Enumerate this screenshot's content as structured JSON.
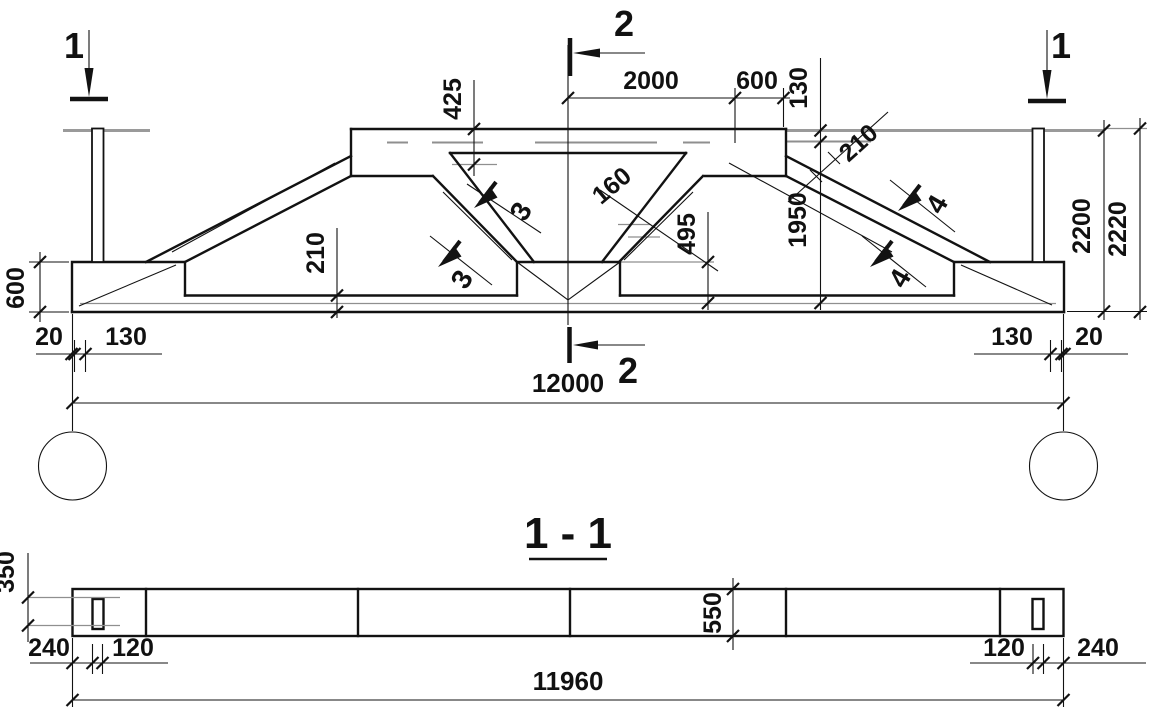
{
  "elevation": {
    "section_markers": {
      "left": "1",
      "right": "1",
      "top": "2",
      "bottom": "2"
    },
    "detail_markers": {
      "d3": "3",
      "d4": "4"
    },
    "dims": {
      "top_2000": "2000",
      "top_600": "600",
      "top_130": "130",
      "h425": "425",
      "d160": "160",
      "h495": "495",
      "h1950": "1950",
      "slope_210": "210",
      "chord_210": "210",
      "left_600": "600",
      "h2200": "2200",
      "h2220": "2220",
      "gap20_left": "20",
      "edge130_left": "130",
      "edge130_right": "130",
      "gap20_right": "20",
      "span_12000": "12000"
    }
  },
  "plan": {
    "title": "1 - 1",
    "dims": {
      "w350": "350",
      "w550": "550",
      "a240_left": "240",
      "a120_left": "120",
      "a120_right": "120",
      "a240_right": "240",
      "length_11960": "11960"
    }
  }
}
